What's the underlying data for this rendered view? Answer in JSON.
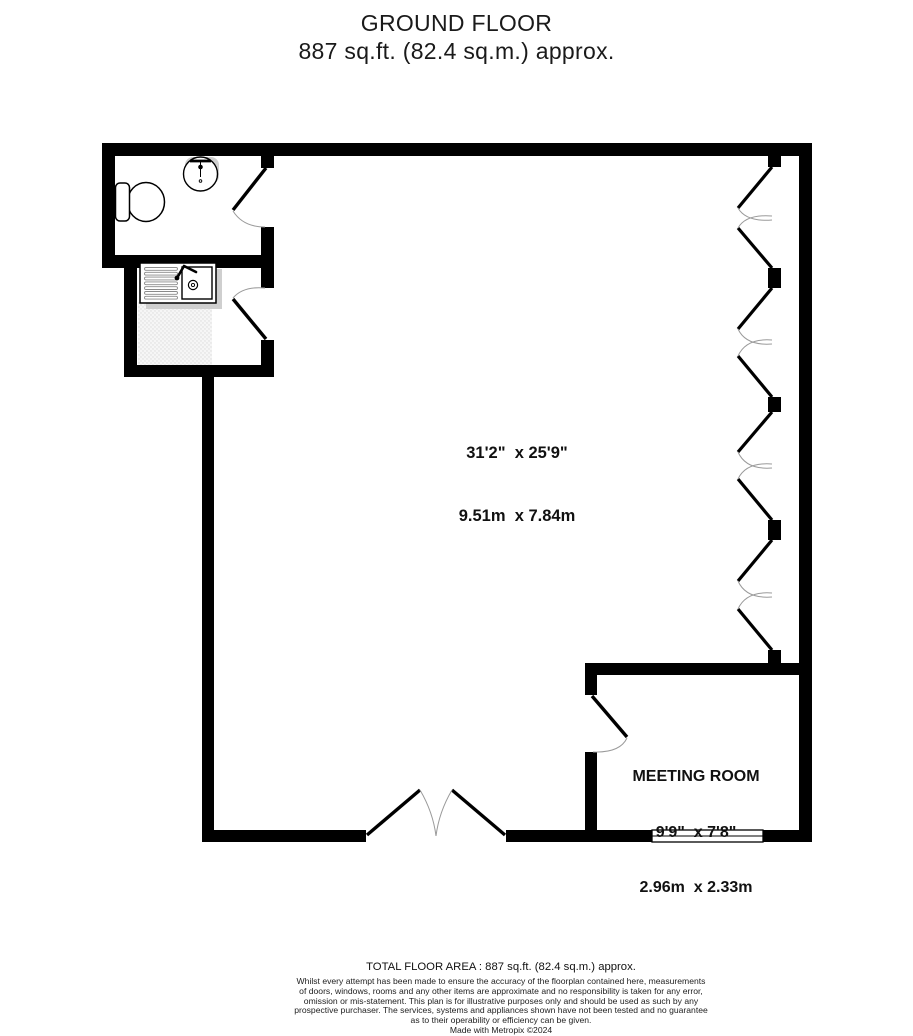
{
  "title": {
    "line1": "GROUND FLOOR",
    "line2": "887 sq.ft. (82.4 sq.m.) approx."
  },
  "rooms": {
    "main": {
      "imperial": "31'2\"  x 25'9\"",
      "metric": "9.51m  x 7.84m"
    },
    "meeting": {
      "name": "MEETING ROOM",
      "imperial": "9'9\"  x 7'8\"",
      "metric": "2.96m  x 2.33m"
    }
  },
  "footer": {
    "area": "TOTAL FLOOR AREA : 887 sq.ft. (82.4 sq.m.) approx.",
    "disclaimer": [
      "Whilst every attempt has been made to ensure the accuracy of the floorplan contained here, measurements",
      "of doors, windows, rooms and any other items are approximate and no responsibility is taken for any error,",
      "omission or mis-statement. This plan is for illustrative purposes only and should be used as such by any",
      "prospective purchaser. The services, systems and appliances shown have not been tested and no guarantee",
      "as to their operability or efficiency can be given."
    ],
    "credit": "Made with Metropix ©2024"
  },
  "colors": {
    "wall": "#000000",
    "swing_arc": "#9a9a9a",
    "fixture_shadow": "#cfcfcf",
    "text": "#1c1c1c"
  }
}
